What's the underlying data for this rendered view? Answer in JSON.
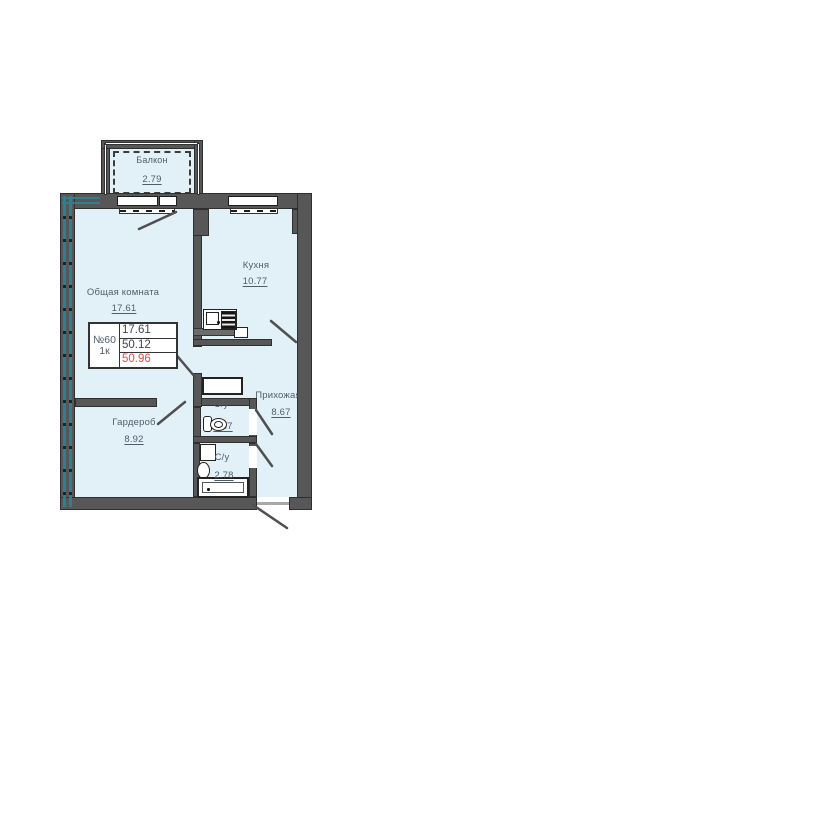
{
  "info_box": {
    "unit_number": "№60",
    "unit_type": "1к",
    "values": [
      "17.61",
      "50.12",
      "50.96"
    ]
  },
  "rooms": {
    "balcony": {
      "name": "Балкон",
      "area": "2.79"
    },
    "living_room": {
      "name": "Общая комната",
      "area": "17.61"
    },
    "kitchen": {
      "name": "Кухня",
      "area": "10.77"
    },
    "hallway": {
      "name": "Прихожая",
      "area": "8.67"
    },
    "wardrobe": {
      "name": "Гардероб",
      "area": "8.92"
    },
    "toilet": {
      "name": "С/у",
      "area": "1.37"
    },
    "bathroom": {
      "name": "С/у",
      "area": "2.78"
    }
  },
  "colors": {
    "wall": "#575757",
    "room-fill": "#e2f1f8",
    "teal": "#2f7f8e",
    "text": "#4e5d69",
    "accent-red": "#ee4a3e",
    "fixture-border": "#222222"
  },
  "icons": {
    "toilet-icon": "css-shape: tank + oval bowl",
    "bath-sink-icon": "css-shape: oval basin",
    "bathtub-icon": "css-shape: bordered tub with drain dot",
    "washing-machine-icon": "css-shape: bordered square",
    "kitchen-sink-icon": "css-shape: counter unit with basin square",
    "stove-icon": "css-shape: striped dark block",
    "vent-shaft-icon": "css-shape: bordered white box",
    "door-swing-icon": "svg-line: door leaf"
  }
}
